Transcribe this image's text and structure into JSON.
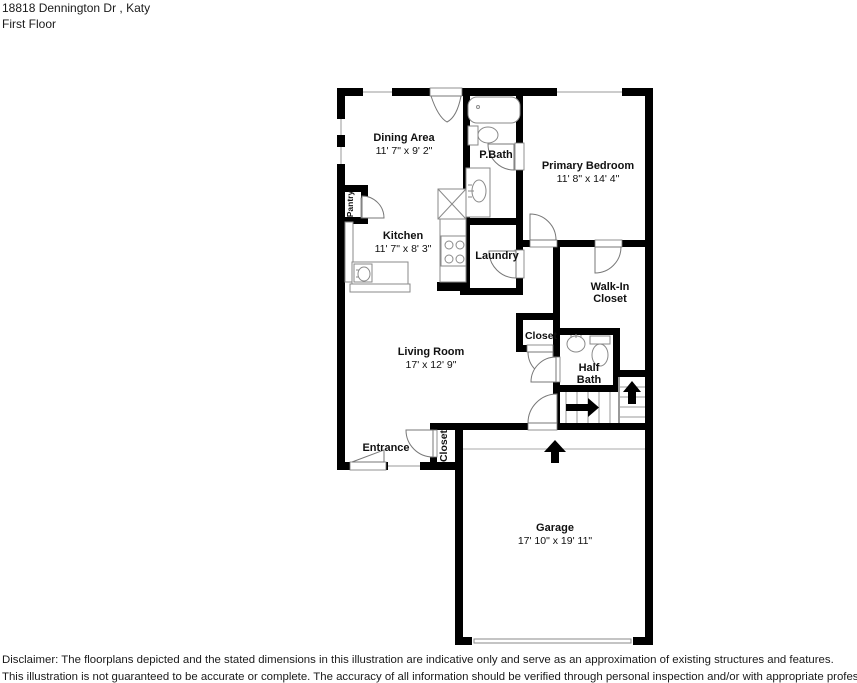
{
  "header": {
    "address": "18818 Dennington Dr , Katy",
    "floor": "First Floor"
  },
  "rooms": {
    "dining": {
      "name": "Dining Area",
      "dims": "11' 7\" x 9' 2\""
    },
    "pbath": {
      "name": "P.Bath"
    },
    "primary_bedroom": {
      "name": "Primary Bedroom",
      "dims": "11' 8\" x 14' 4\""
    },
    "pantry": {
      "name": "Pantry"
    },
    "kitchen": {
      "name": "Kitchen",
      "dims": "11' 7\" x 8' 3\""
    },
    "laundry": {
      "name": "Laundry"
    },
    "walk_in_closet": {
      "line1": "Walk-In",
      "line2": "Closet"
    },
    "closet_hall": {
      "name": "Closet"
    },
    "half_bath": {
      "line1": "Half",
      "line2": "Bath"
    },
    "living": {
      "name": "Living Room",
      "dims": "17' x 12' 9\""
    },
    "entrance": {
      "name": "Entrance"
    },
    "closet_entry": {
      "name": "Closet"
    },
    "garage": {
      "name": "Garage",
      "dims": "17' 10\" x 19' 11\""
    }
  },
  "disclaimer": {
    "line1": "Disclaimer: The floorplans depicted and the stated dimensions in this illustration are indicative only and serve as an approximation of existing structures and features.",
    "line2": "This illustration is not guaranteed to be accurate or complete. The accuracy of all information should be verified through personal inspection and/or with appropriate professionals"
  },
  "colors": {
    "wall": "#000000",
    "fixture_stroke": "#8a8a8a",
    "door_stroke": "#777777",
    "background": "#ffffff",
    "text": "#111111"
  }
}
